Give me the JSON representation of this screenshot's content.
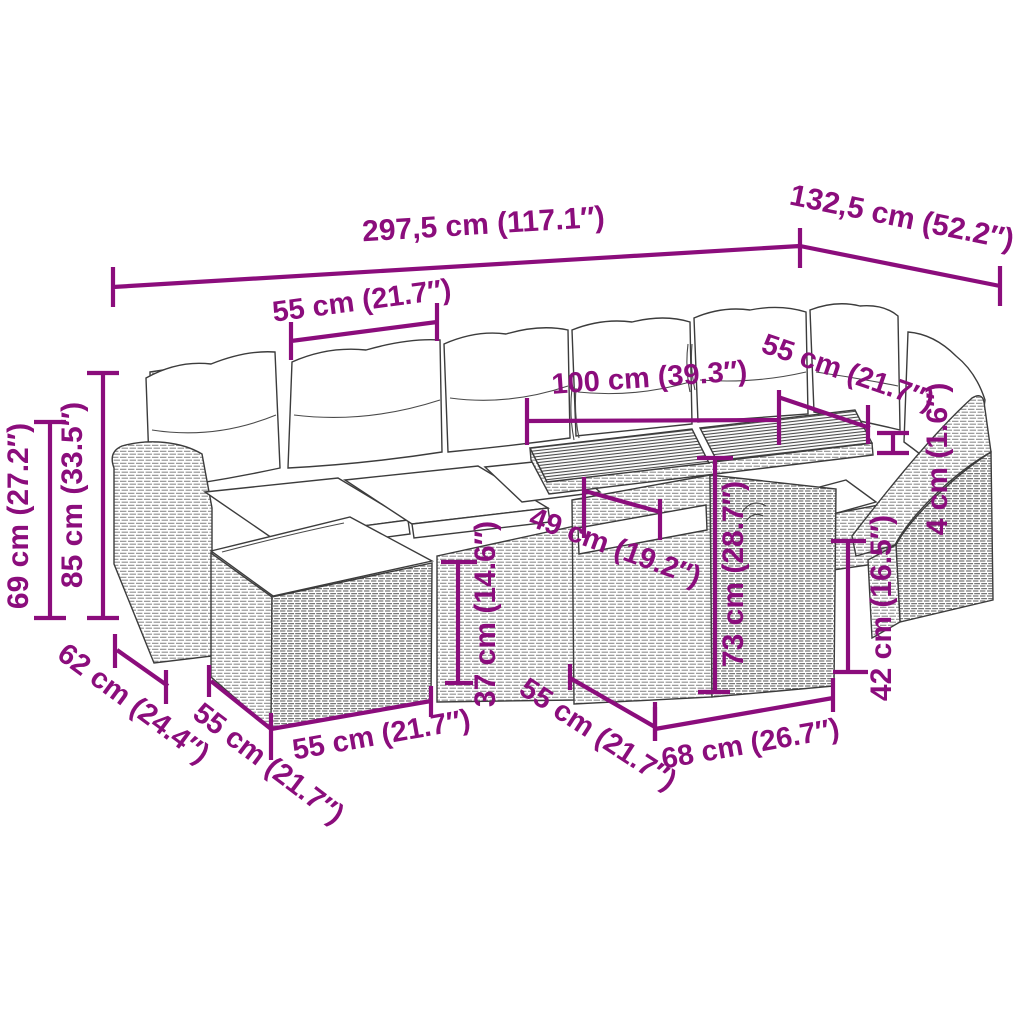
{
  "figure": {
    "type": "product-dimension-diagram",
    "subject": "garden lounge set with sofa, footstool, slatted table and armchair",
    "background": "#ffffff",
    "accent_color": "#8B0D7C",
    "outline_color": "#3c3c3c"
  },
  "dimensions": {
    "total_width": "297,5 cm (117.1″)",
    "total_depth": "132,5 cm (52.2″)",
    "back_seat_width": "55 cm (21.7″)",
    "table_length": "100 cm (39.3″)",
    "right_seat_width": "55 cm (21.7″)",
    "tabletop_thickness": "4 cm (1.6″)",
    "arm_height": "69 cm (27.2″)",
    "total_height": "85 cm (33.5″)",
    "seat_depth": "62 cm (24.4″)",
    "stool_depth": "55 cm (21.7″)",
    "stool_width": "55 cm (21.7″)",
    "stool_height": "37 cm (14.6″)",
    "table_overhang": "49 cm (19.2″)",
    "table_height": "73 cm (28.7″)",
    "seat_height": "42 cm (16.5″)",
    "table_base_width": "68 cm (26.7″)",
    "table_depth": "55 cm (21.7″)"
  }
}
